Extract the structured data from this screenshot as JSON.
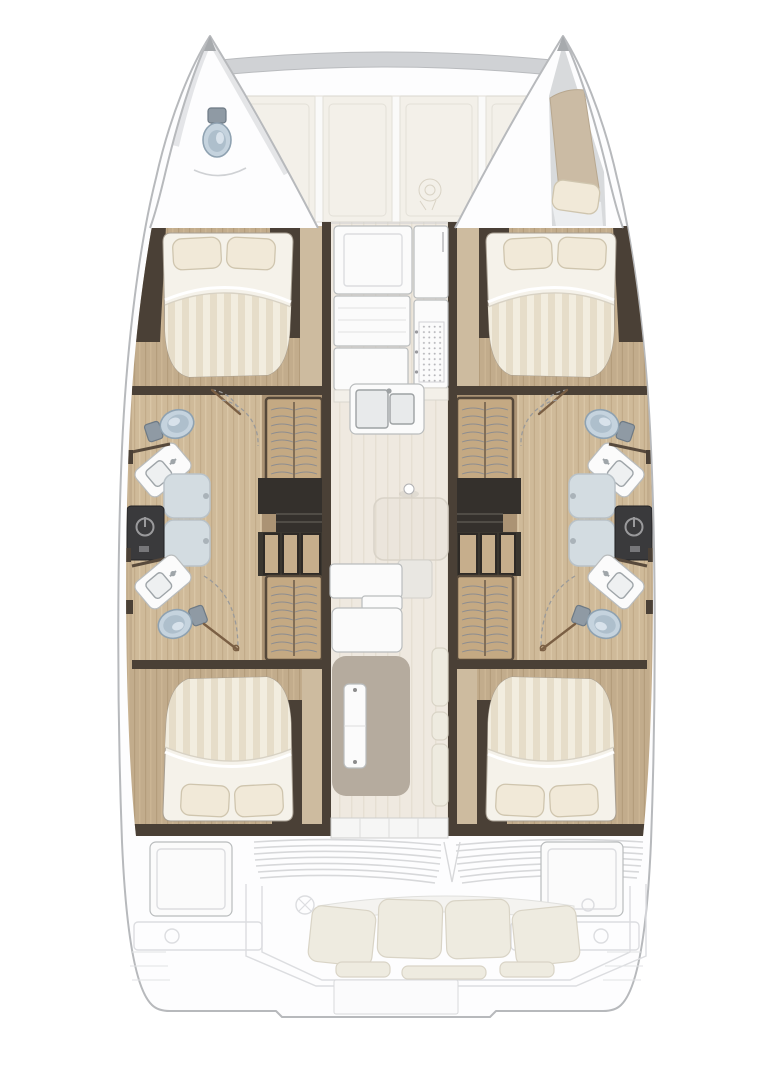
{
  "meta": {
    "title": "Catamaran deck and accommodation floor plan, bow up",
    "orientation": "bow-up",
    "visible_text": []
  },
  "palette": {
    "hullFill": "#fdfdfe",
    "hullStroke": "#b7b9bc",
    "beamFill": "#d0d2d5",
    "panelCream": "#f3f0e9",
    "panelBorder": "#d9d6ce",
    "panelWhite": "#fafaf9",
    "woodDark": "#4a4036",
    "woodMid": "#ab9374",
    "woodLight": "#cdbb9f",
    "floorWood": "#c2ac8c",
    "floorWoodLight": "#cfba99",
    "saloonFloor": "#efe9e0",
    "saloonStripe": "#e6dfd3",
    "bedSheet": "#f5f2ea",
    "bedStripeA": "#e6ddc9",
    "bedStripeB": "#f2eddf",
    "pillow": "#f1e9d8",
    "pillowEdge": "#cfc5ae",
    "fixWhite": "#fbfbfb",
    "fixStroke": "#b9bcbd",
    "toiletBlue": "#c5d3de",
    "toiletRim": "#8fa2b1",
    "toiletInner": "#aebfcc",
    "cistern": "#8f9aa4",
    "showerFill": "#d3dce1",
    "showerStroke": "#b9c2c8",
    "charcoal": "#3a3a3c",
    "stairDark": "#34302c",
    "tread": "#c6ae8c",
    "wardrobe": "#c4a983",
    "wardrobeEdge": "#55483a",
    "garmentLine": "#8d8d90",
    "tableTan": "#b5ab9e",
    "cushionFill": "#eeebe0",
    "cushionEdge": "#d9d4c6",
    "cockpitLine": "#dcdde0",
    "doorArc": "#9a9a9a",
    "doorLeaf": "#7a5f44",
    "deckGray": "#d8dadc",
    "berthTan": "#cbbba4"
  },
  "vessel": {
    "bows": [
      {
        "side": "port",
        "fixture": "toilet"
      },
      {
        "side": "starboard",
        "fixture": "single-berth-with-cushion"
      }
    ],
    "hulls": [
      {
        "side": "port",
        "rooms": [
          "double-cabin-forward",
          "bathroom-forward",
          "shower",
          "bathroom-aft",
          "double-cabin-aft"
        ],
        "storage": [
          "hanging-locker-forward",
          "companionway-stairs",
          "hanging-locker-aft"
        ]
      },
      {
        "side": "starboard",
        "rooms": [
          "double-cabin-forward",
          "bathroom-forward",
          "shower",
          "bathroom-aft",
          "double-cabin-aft"
        ],
        "storage": [
          "hanging-locker-forward",
          "companionway-stairs",
          "hanging-locker-aft"
        ]
      }
    ],
    "saloon": {
      "features": [
        "galley-counter-port",
        "appliance-front",
        "refrigerator",
        "stove-grid",
        "double-sink",
        "mast-step",
        "saloon-table",
        "settee",
        "dinette-table",
        "starboard-seat-cushions",
        "aft-sliding-door"
      ]
    },
    "foredeck": {
      "features": [
        "cross-beam",
        "deck-panels",
        "windlass"
      ]
    },
    "cockpit": {
      "features": [
        "vent-louvers-port",
        "vent-louvers-starboard",
        "storage-locker-port",
        "storage-locker-starboard",
        "bench-seat",
        "helm-detail",
        "transom-platform"
      ]
    },
    "counts": {
      "double_cabins": 4,
      "toilets": 5,
      "sinks": 5,
      "showers": 2,
      "hanging_lockers": 4,
      "cockpit_bench_cushions": 4
    }
  }
}
